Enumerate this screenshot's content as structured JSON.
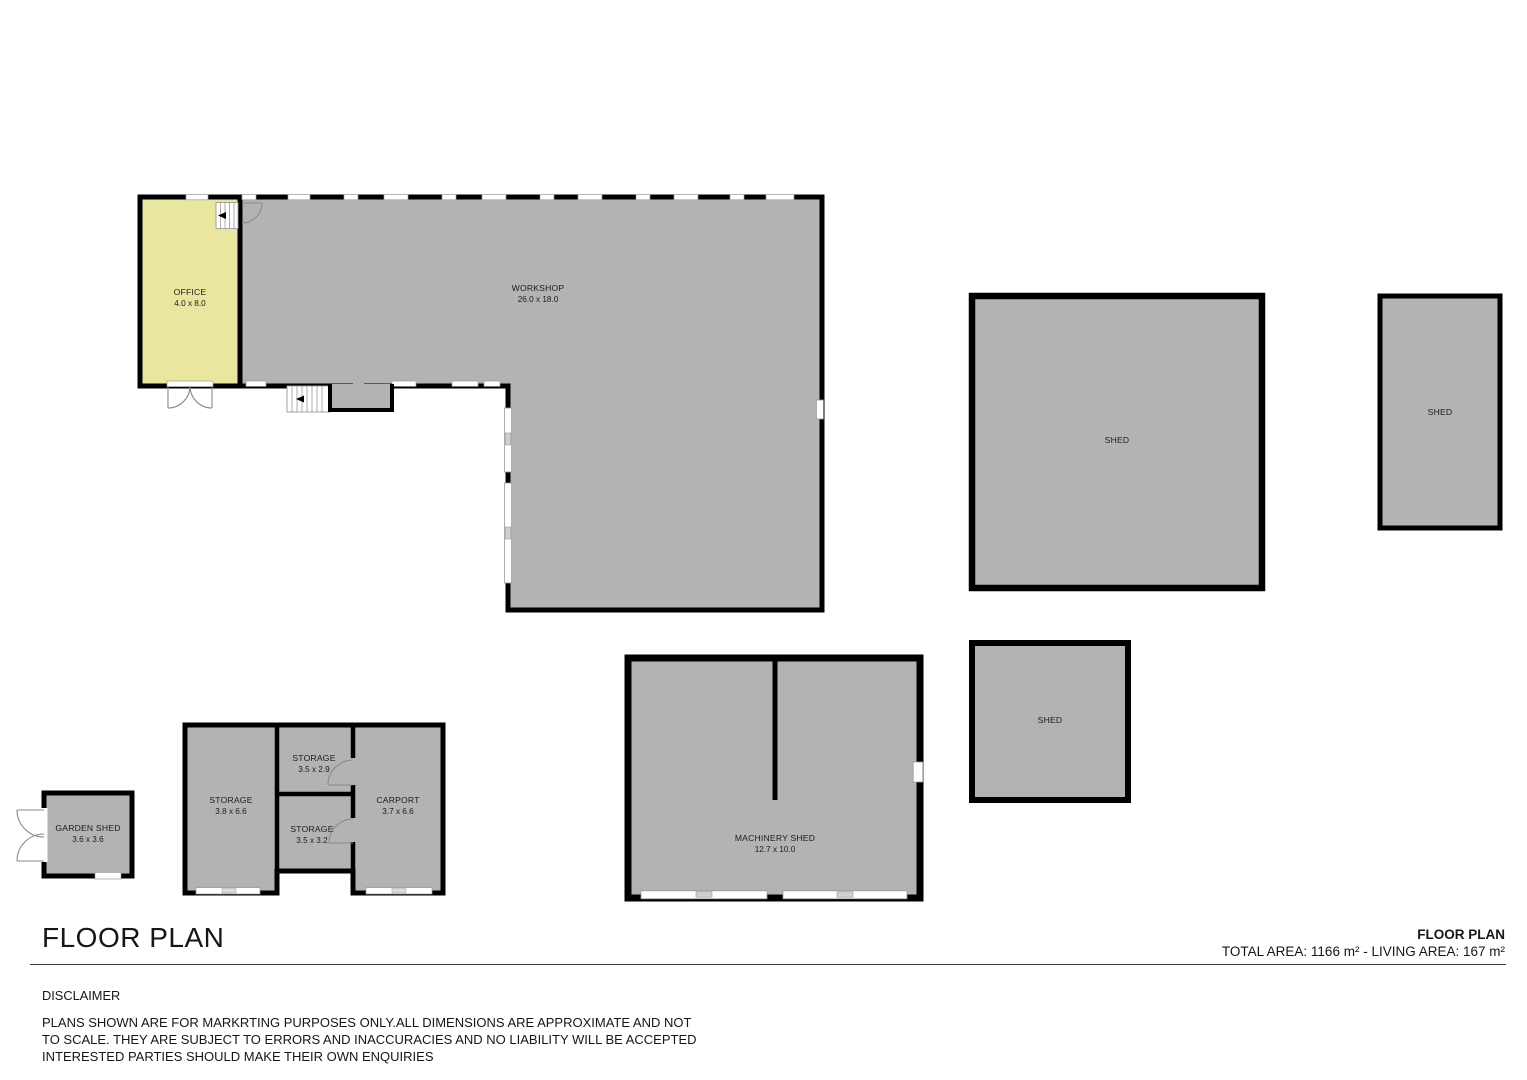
{
  "colors": {
    "room_fill": "#b3b3b3",
    "office_fill": "#e9e6a0",
    "wall": "#000000",
    "window_fill": "#ffffff",
    "window_stroke": "#9a9a9a"
  },
  "rooms": {
    "office": {
      "name": "OFFICE",
      "dims": "4.0 x 8.0"
    },
    "workshop": {
      "name": "WORKSHOP",
      "dims": "26.0 x 18.0"
    },
    "shed_large": {
      "name": "SHED"
    },
    "shed_narrow": {
      "name": "SHED"
    },
    "shed_small": {
      "name": "SHED"
    },
    "machinery_shed": {
      "name": "MACHINERY SHED",
      "dims": "12.7 x 10.0"
    },
    "garden_shed": {
      "name": "GARDEN SHED",
      "dims": "3.6 x 3.6"
    },
    "storage_left": {
      "name": "STORAGE",
      "dims": "3.8 x 6.6"
    },
    "storage_top": {
      "name": "STORAGE",
      "dims": "3.5 x 2.9"
    },
    "storage_bottom": {
      "name": "STORAGE",
      "dims": "3.5 x 3.2"
    },
    "carport": {
      "name": "CARPORT",
      "dims": "3.7 x 6.6"
    }
  },
  "footer": {
    "title": "FLOOR PLAN",
    "plan_label": "FLOOR PLAN",
    "area_summary": "TOTAL AREA: 1166 m² - LIVING AREA:  167 m²",
    "disclaimer_heading": "DISCLAIMER",
    "disclaimer_line1": "PLANS SHOWN ARE FOR MARKRTING PURPOSES ONLY.ALL DIMENSIONS ARE APPROXIMATE AND NOT",
    "disclaimer_line2": "TO SCALE. THEY ARE SUBJECT TO ERRORS AND INACCURACIES AND NO LIABILITY WILL BE ACCEPTED",
    "disclaimer_line3": "INTERESTED PARTIES SHOULD MAKE THEIR OWN ENQUIRIES"
  }
}
